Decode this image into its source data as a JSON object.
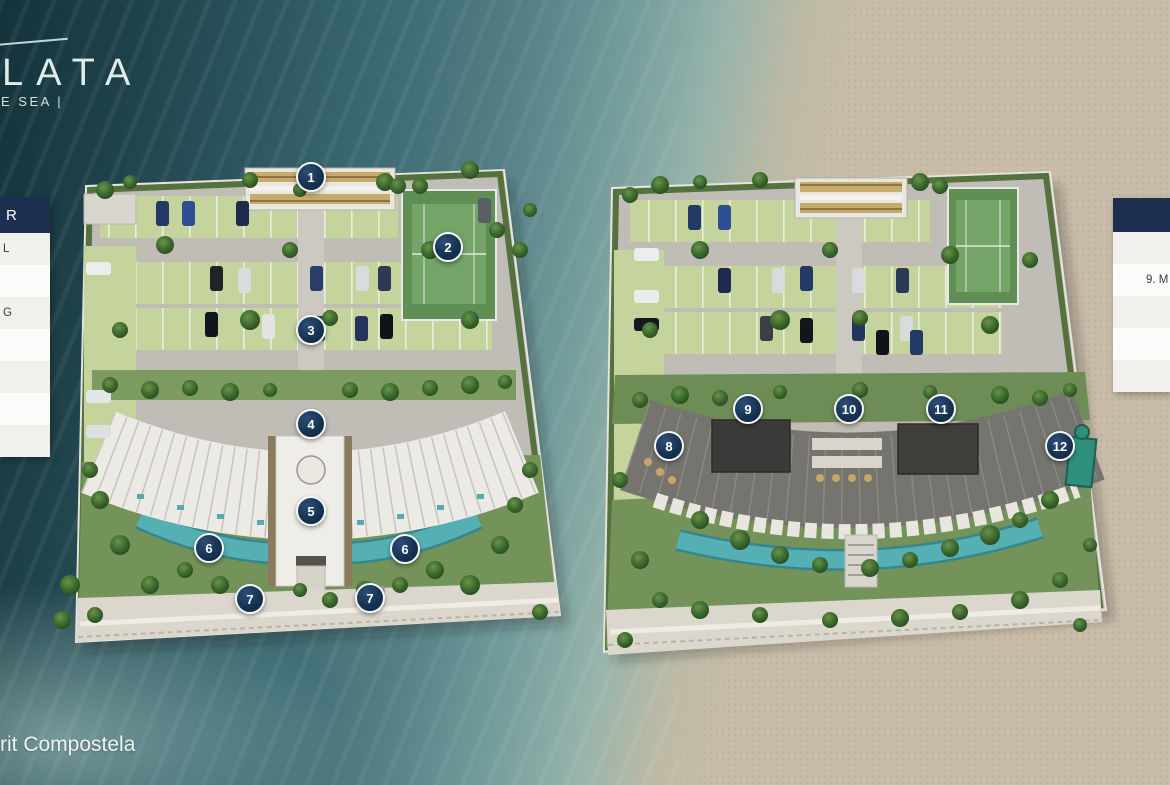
{
  "brand": {
    "name_fragment": "LATA",
    "tagline_fragment": "E SEA |"
  },
  "footer": {
    "location_fragment": "rit Compostela"
  },
  "legend_left": {
    "header_fragment": "R",
    "rows": [
      "L",
      "",
      "G",
      "",
      "",
      "",
      ""
    ]
  },
  "legend_right": {
    "header_fragment": "",
    "rows": [
      "",
      "9. M",
      "",
      "",
      ""
    ]
  },
  "markers": [
    {
      "label": "1",
      "x": 311,
      "y": 177
    },
    {
      "label": "2",
      "x": 448,
      "y": 247
    },
    {
      "label": "3",
      "x": 311,
      "y": 330
    },
    {
      "label": "4",
      "x": 311,
      "y": 424
    },
    {
      "label": "5",
      "x": 311,
      "y": 511
    },
    {
      "label": "6",
      "x": 209,
      "y": 548
    },
    {
      "label": "6",
      "x": 405,
      "y": 549
    },
    {
      "label": "7",
      "x": 250,
      "y": 599
    },
    {
      "label": "7",
      "x": 370,
      "y": 598
    },
    {
      "label": "8",
      "x": 669,
      "y": 446
    },
    {
      "label": "9",
      "x": 748,
      "y": 409
    },
    {
      "label": "10",
      "x": 849,
      "y": 409
    },
    {
      "label": "11",
      "x": 941,
      "y": 409
    },
    {
      "label": "12",
      "x": 1060,
      "y": 446
    }
  ],
  "colors": {
    "marker_navy": "#16314f",
    "marker_navy_highlight": "#2c4d77",
    "panel_navy": "#1c2f4e",
    "water_dark": "#14323a",
    "water_mid": "#547f84",
    "sand": "#c9bda9",
    "pool_teal": "#4fa9ad",
    "court_green": "#6f9e63",
    "grass_paver": "#c5d39c"
  }
}
